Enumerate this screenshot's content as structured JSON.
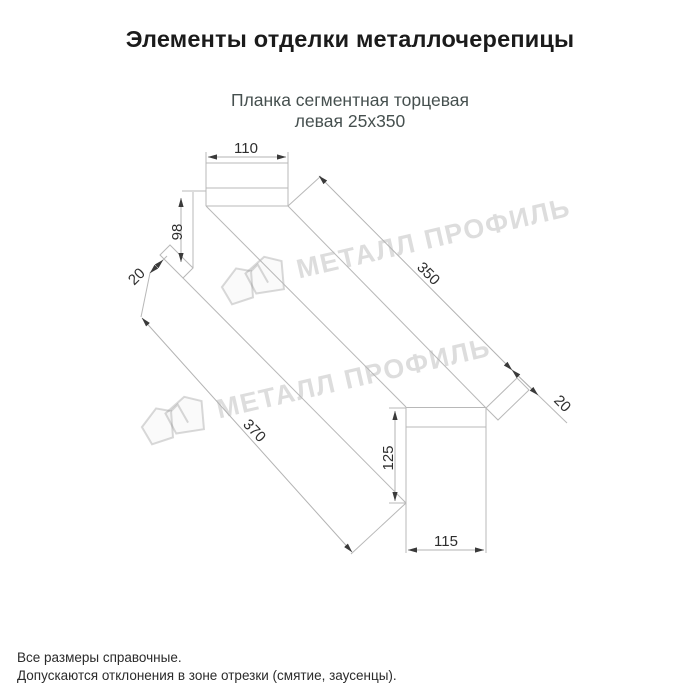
{
  "page": {
    "title": "Элементы отделки металлочерепицы"
  },
  "product": {
    "subtitle_line1": "Планка сегментная торцевая",
    "subtitle_line2": "левая 25х350"
  },
  "drawing": {
    "dims": {
      "top_width": "110",
      "left_height": "98",
      "left_hem": "20",
      "top_length": "350",
      "bottom_length": "370",
      "right_hem": "20",
      "right_height": "125",
      "bottom_width": "115"
    }
  },
  "watermark": {
    "brand": "МЕТАЛЛ ПРОФИЛЬ"
  },
  "footer": {
    "line1": "Все размеры справочные.",
    "line2": "Допускаются отклонения в зоне отрезки (смятие, заусенцы)."
  },
  "colors": {
    "line": "#b8b8b8",
    "dim_text": "#2e2e2e",
    "subtitle": "#46504f",
    "watermark": "#c9c9c9"
  }
}
